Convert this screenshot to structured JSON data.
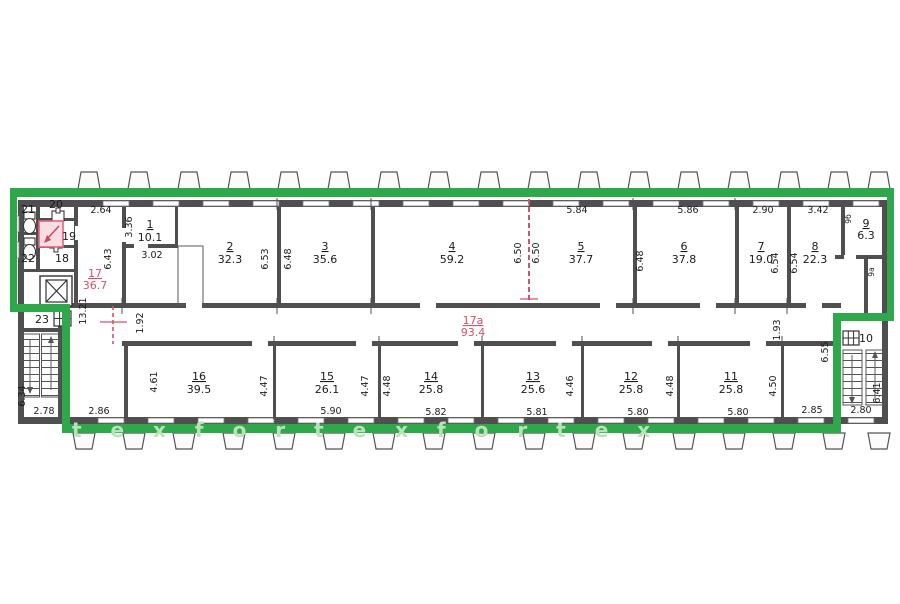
{
  "rooms": {
    "r1": {
      "n": "1",
      "a": "10.1"
    },
    "r2": {
      "n": "2",
      "a": "32.3"
    },
    "r3": {
      "n": "3",
      "a": "35.6"
    },
    "r4": {
      "n": "4",
      "a": "59.2"
    },
    "r5": {
      "n": "5",
      "a": "37.7"
    },
    "r6": {
      "n": "6",
      "a": "37.8"
    },
    "r7": {
      "n": "7",
      "a": "19.0"
    },
    "r8": {
      "n": "8",
      "a": "22.3"
    },
    "r9": {
      "n": "9",
      "a": "6.3"
    },
    "r10": {
      "n": "10"
    },
    "r11": {
      "n": "11",
      "a": "25.8"
    },
    "r12": {
      "n": "12",
      "a": "25.8"
    },
    "r13": {
      "n": "13",
      "a": "25.6"
    },
    "r14": {
      "n": "14",
      "a": "25.8"
    },
    "r15": {
      "n": "15",
      "a": "26.1"
    },
    "r16": {
      "n": "16",
      "a": "39.5"
    },
    "r17": {
      "n": "17",
      "a": "36.7"
    },
    "r17a": {
      "n": "17а",
      "a": "93.4"
    },
    "r18": {
      "n": "18"
    },
    "r19": {
      "n": "19"
    },
    "r20": {
      "n": "20"
    },
    "r21": {
      "n": "21"
    },
    "r22": {
      "n": "22"
    },
    "r23": {
      "n": "23"
    },
    "r9a": {
      "n": "9а"
    },
    "r9b": {
      "n": "9б"
    }
  },
  "dims": {
    "d264": "2.64",
    "d336": "3.36",
    "d302": "3.02",
    "d643": "6.43",
    "d1321": "13.21",
    "d653": "6.53",
    "d648": "6.48",
    "d650": "6.50",
    "d584": "5.84",
    "d586": "5.86",
    "d290": "2.90",
    "d342": "3.42",
    "d654": "6.54",
    "d192": "1.92",
    "d193": "1.93",
    "d655": "6.55",
    "d461": "4.61",
    "d447": "4.47",
    "d448": "4.48",
    "d446": "4.46",
    "d450": "4.50",
    "d634": "6.34",
    "d641": "6.41",
    "d278": "2.78",
    "d286": "2.86",
    "d590": "5.90",
    "d582": "5.82",
    "d581": "5.81",
    "d580": "5.80",
    "d285": "2.85",
    "d280": "2.80"
  },
  "watermark": "t e x   f o r t e x   f o r t e x",
  "colors": {
    "boundary": "#2fa84c",
    "wall": "#4f4f4f",
    "annotation_red": "#d8506a",
    "watermark_green": "#b9e2ba"
  }
}
